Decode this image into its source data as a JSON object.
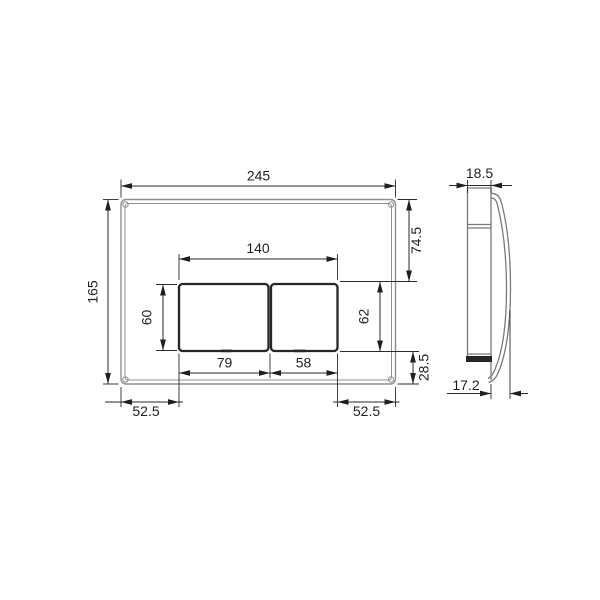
{
  "colors": {
    "ink": "#1f1f1f",
    "dim_line": "#2a2a2a",
    "part_outline": "#8f8f8f",
    "side_outline": "#7a7a7a",
    "button_outline": "#262626",
    "background": "#ffffff"
  },
  "dimensions": {
    "front": {
      "overall_width": "245",
      "overall_height": "165",
      "button_group_width": "140",
      "top_to_buttons": "74.5",
      "opening_height": "62",
      "bottom_offset": "28.5",
      "button_height": "60",
      "large_button_width": "79",
      "small_button_width": "58",
      "bottom_left_offset": "52.5",
      "bottom_right_offset": "52.5"
    },
    "side": {
      "frame_depth": "18.5",
      "cover_projection": "17.2"
    }
  }
}
